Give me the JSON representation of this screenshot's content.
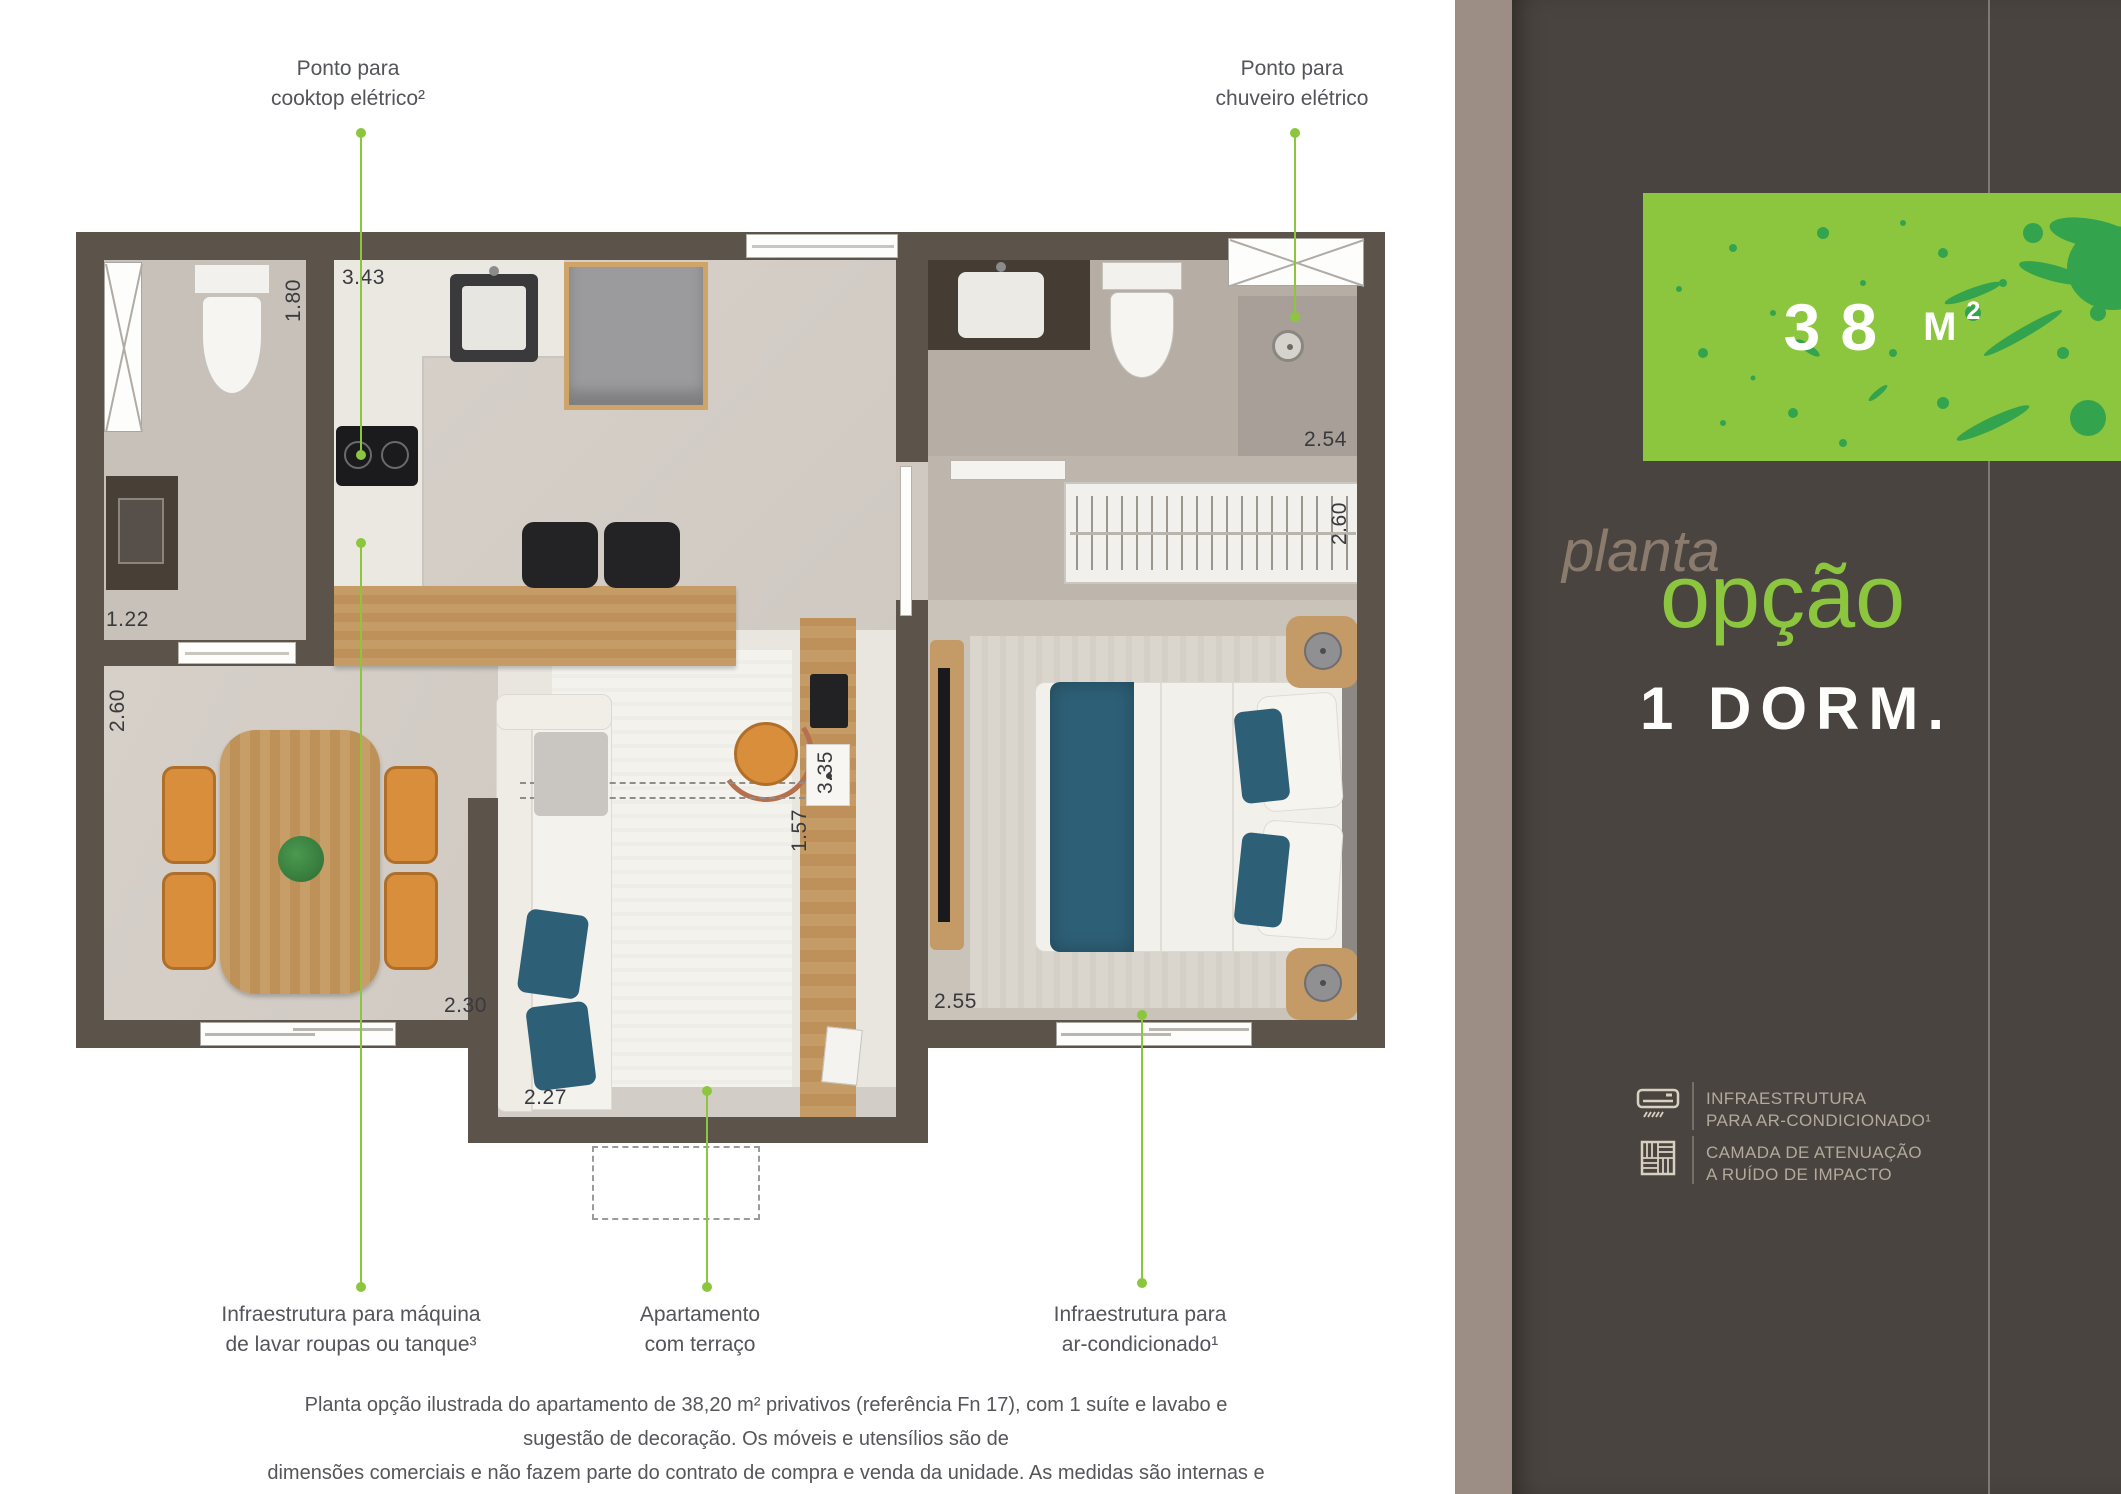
{
  "callouts": {
    "cooktop": "Ponto para\ncooktop elétrico²",
    "chuveiro": "Ponto para\nchuveiro elétrico",
    "lavanderia": "Infraestrutura para máquina\nde lavar roupas ou tanque³",
    "terraco": "Apartamento\ncom terraço",
    "ar_condicionado": "Infraestrutura para\nar-condicionado¹"
  },
  "dims": {
    "lavabo_h": "1.80",
    "kitchen_w": "3.43",
    "laundry_w": "1.22",
    "living_h": "2.60",
    "living_w": "2.30",
    "terraco_w": "2.27",
    "terraco_h": "1.57",
    "hall_h": "3.35",
    "bedroom_w": "2.55",
    "shower_w": "2.54",
    "closet_h": "2.60"
  },
  "panel": {
    "area_value": "38",
    "area_unit": "M",
    "area_exp": "2",
    "title_script": "planta",
    "title_main": "opção",
    "title_sub": "1 DORM.",
    "legend": [
      {
        "line1": "INFRAESTRUTURA",
        "line2": "PARA AR-CONDICIONADO¹",
        "icon": "ac-unit-icon"
      },
      {
        "line1": "CAMADA DE ATENUAÇÃO",
        "line2": "A RUÍDO DE IMPACTO",
        "icon": "parquet-icon"
      }
    ]
  },
  "disclaimer": {
    "line1": "Planta opção ilustrada do apartamento de 38,20 m² privativos (referência Fn 17), com 1 suíte e lavabo e sugestão de decoração. Os móveis e utensílios são de",
    "line2": "dimensões comerciais e não fazem parte do contrato de compra e venda da unidade. As medidas são internas e de face a face das paredes."
  },
  "colors": {
    "accent_green": "#8cc63e",
    "splatter_green": "#2da14f",
    "panel_dark": "#49443f",
    "panel_strip": "#9c8d85",
    "wall": "#5c544b",
    "teal": "#2d5f76",
    "wood": "#c49a66",
    "chair_orange": "#d98e3c"
  }
}
